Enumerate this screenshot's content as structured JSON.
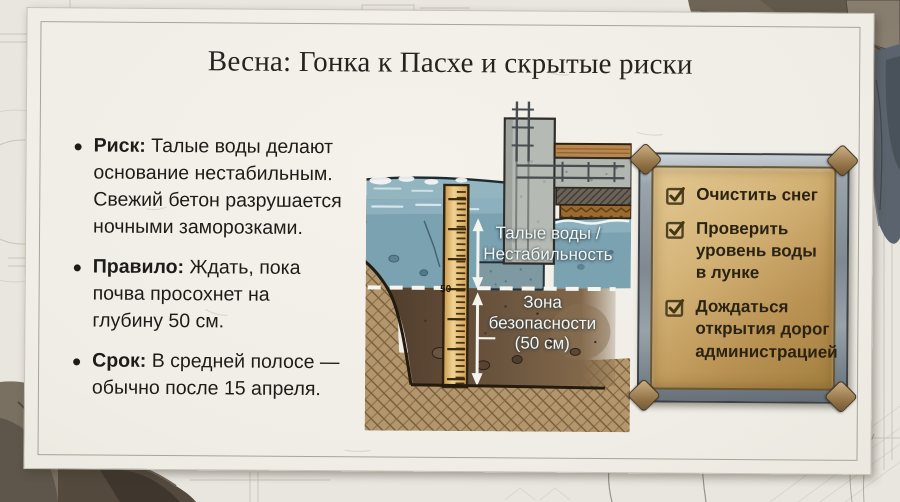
{
  "slide": {
    "title": "Весна: Гонка к Пасхе и скрытые риски"
  },
  "bullets": [
    {
      "lead": "Риск:",
      "text": "Талые воды делают\nоснование нестабильным.\nСвежий бетон разрушается\nночными заморозками."
    },
    {
      "lead": "Правило:",
      "text": "Ждать, пока\nпочва просохнет на\nглубину 50 см."
    },
    {
      "lead": "Срок:",
      "text": "В средней полосе —\nобычно после 15 апреля."
    }
  ],
  "diagram": {
    "water_label": "Талые воды /\nНестабильность",
    "zone_label": "Зона\nбезопасности\n(50 см)",
    "ruler_mark": "50"
  },
  "checklist": {
    "items": [
      {
        "label": "Очистить снег",
        "checked": true
      },
      {
        "label": "Проверить\nуровень воды\nв лунке",
        "checked": true
      },
      {
        "label": "Дождаться\nоткрытия дорог\nадминистрацией",
        "checked": true
      }
    ]
  },
  "colors": {
    "water": "#7ba2b1",
    "topsoil": "#7b5c3b",
    "safety_soil": "#6b523a",
    "board_face": "#c9a864",
    "board_frame": "#8d979e",
    "ruler": "#e3bd74",
    "paper": "#efede5"
  }
}
